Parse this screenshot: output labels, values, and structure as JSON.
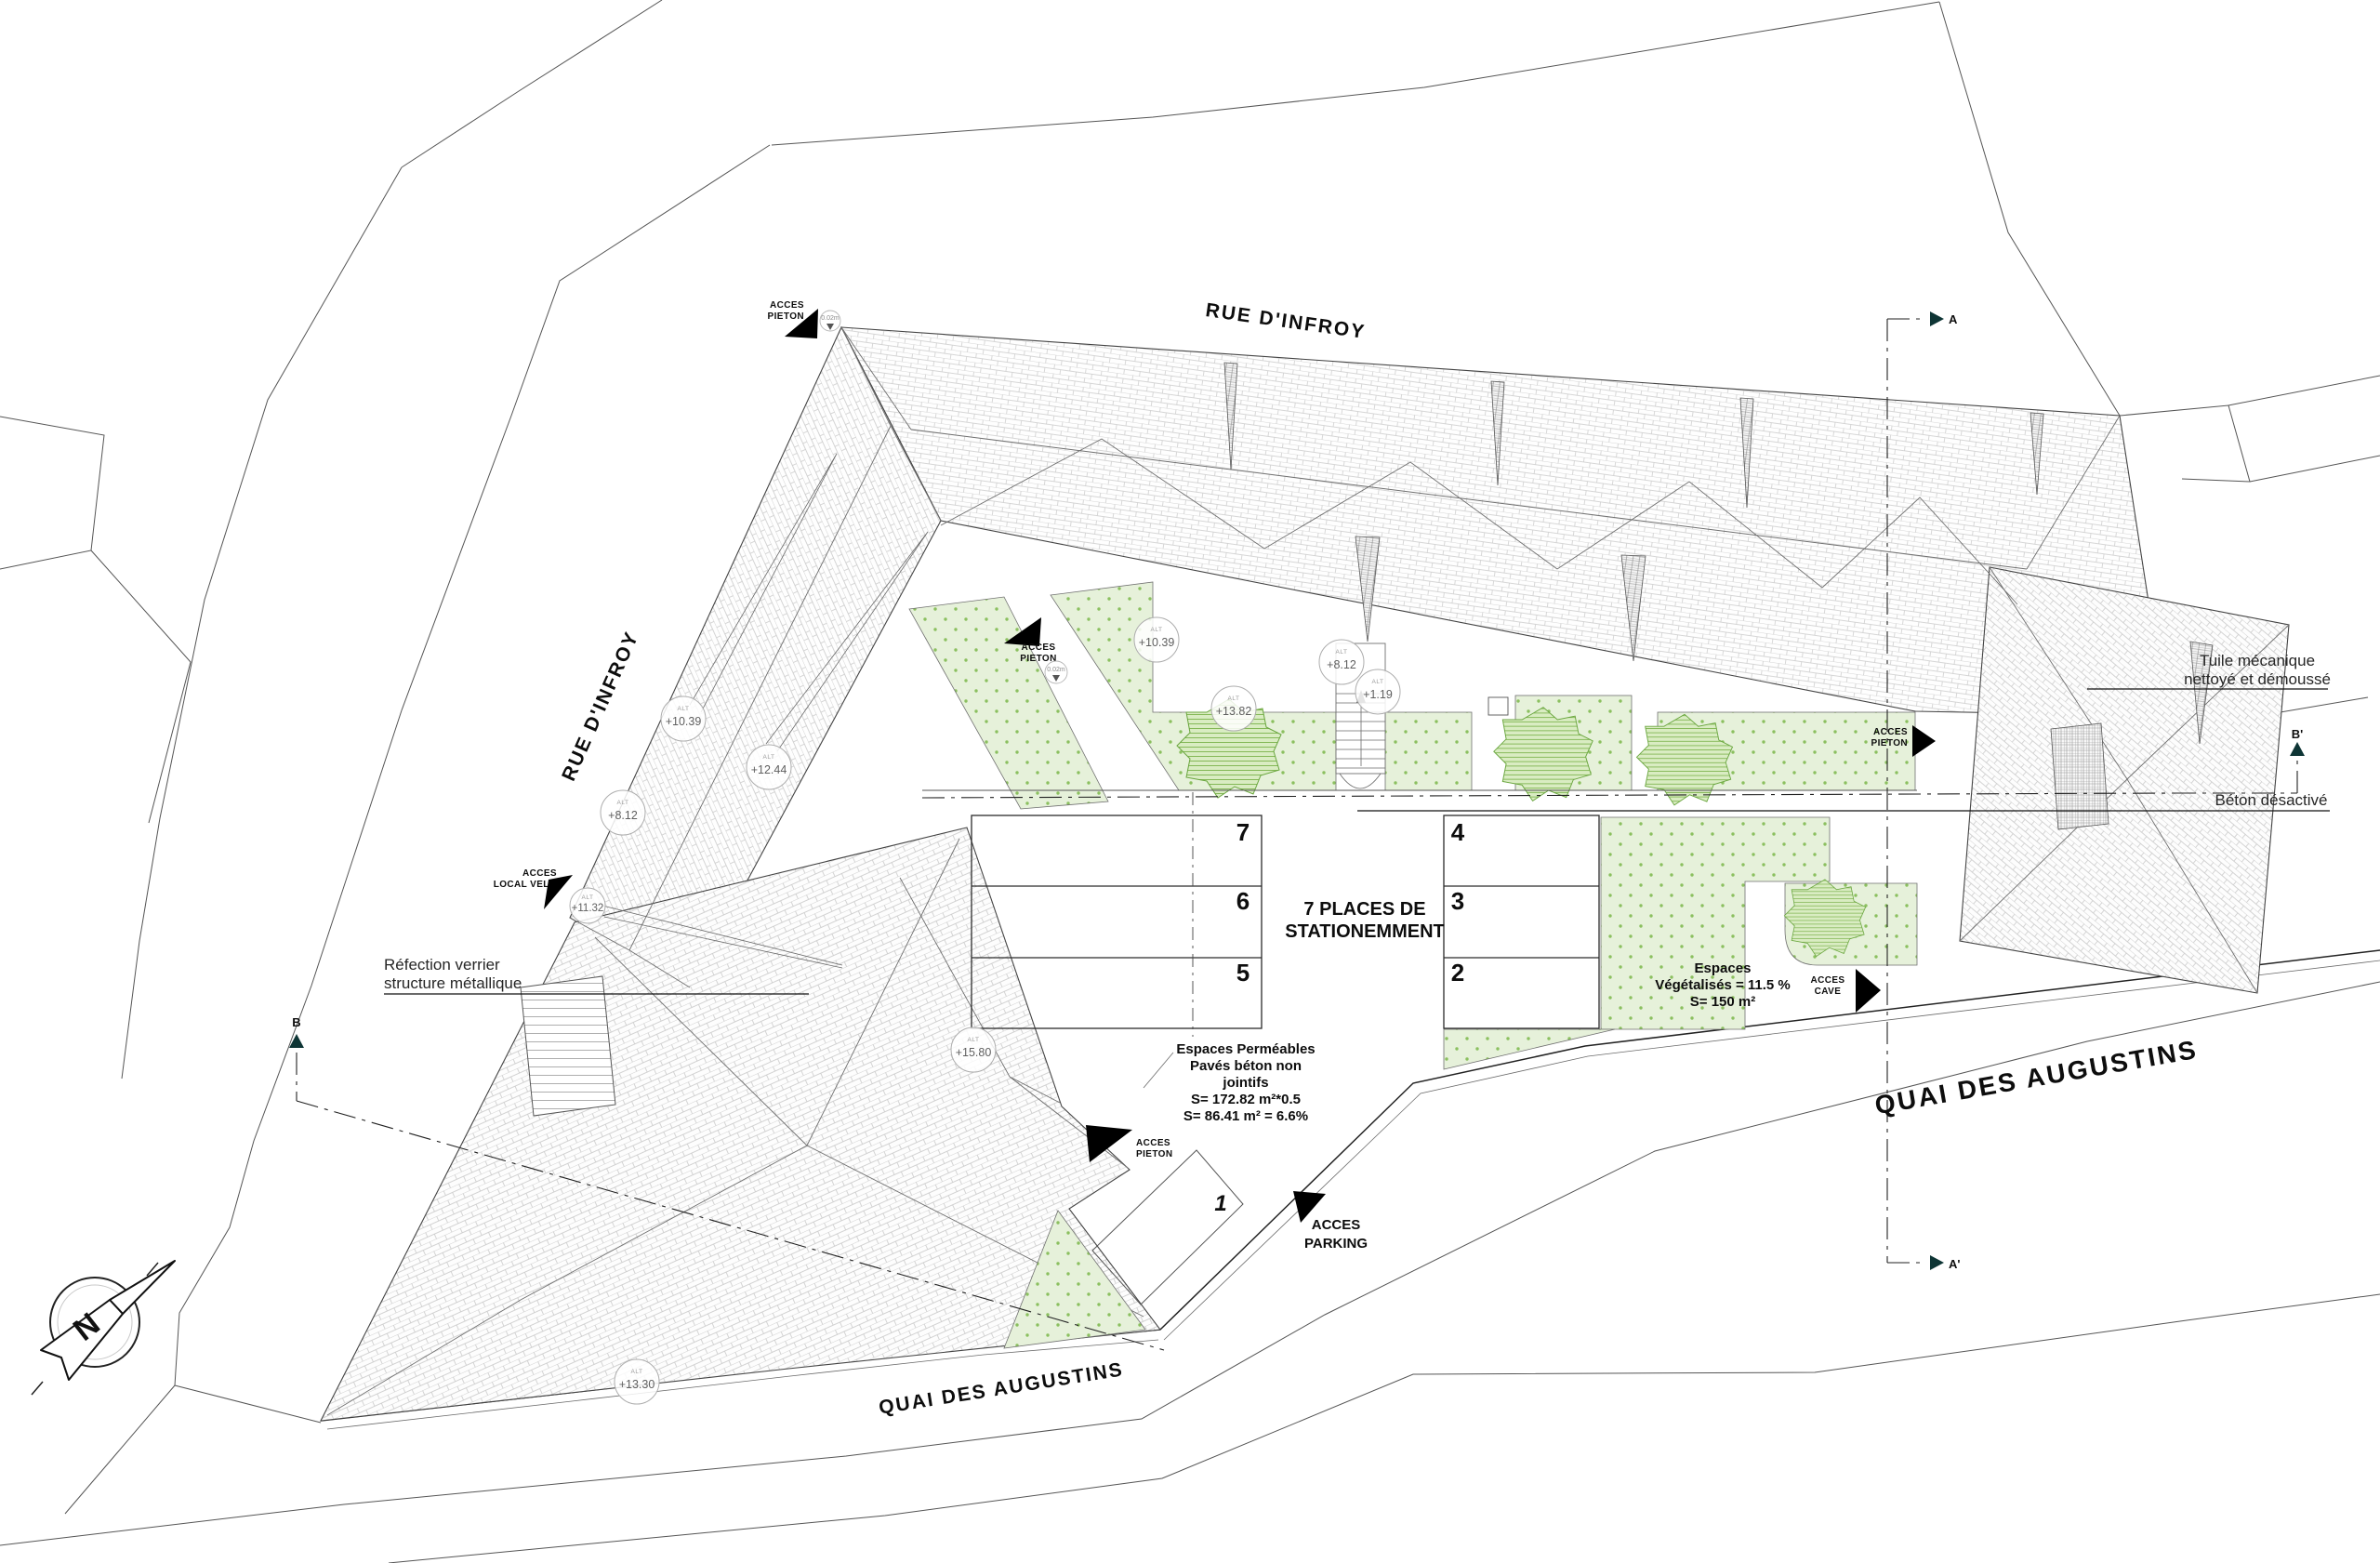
{
  "streets": {
    "top": "RUE D'INFROY",
    "left": "RUE D'INFROY",
    "bottom": "QUAI DES AUGUSTINS",
    "right": "QUAI DES AUGUSTINS"
  },
  "access": {
    "acces": "ACCES",
    "pieton": "PIETON",
    "local_velo": "LOCAL VELO",
    "cave": "CAVE",
    "parking": "PARKING"
  },
  "parking_area": {
    "title_line1": "7 PLACES DE",
    "title_line2": "STATIONEMMENT",
    "stalls": [
      "1",
      "2",
      "3",
      "4",
      "5",
      "6",
      "7"
    ]
  },
  "notes": {
    "permeable": [
      "Espaces Perméables",
      "Pavés béton non",
      "jointifs",
      "S= 172.82 m²*0.5",
      "S= 86.41 m² = 6.6%"
    ],
    "vegetal": [
      "Espaces",
      "Végétalisés = 11.5 %",
      "S= 150 m²"
    ],
    "tuile": [
      "Tuile mécanique",
      "nettoyé et démoussé"
    ],
    "beton": "Béton désactivé",
    "verrier": [
      "Réfection verrier",
      "structure métallique"
    ]
  },
  "levels": [
    {
      "label": "+10.39"
    },
    {
      "label": "+12.44"
    },
    {
      "label": "+8.12"
    },
    {
      "label": "+10.39"
    },
    {
      "label": "+13.82"
    },
    {
      "label": "+8.12"
    },
    {
      "label": "+1.19"
    },
    {
      "label": "+11.32"
    },
    {
      "label": "+15.80"
    },
    {
      "label": "+13.30"
    }
  ],
  "misc": {
    "alt": "ALT",
    "threshold": "0.02m"
  },
  "sections": {
    "a": "A",
    "a_prime": "A'",
    "b": "B",
    "b_prime": "B'"
  },
  "compass": {
    "north": "N"
  },
  "colors": {
    "green_fill": "#e6f1da",
    "green_dot": "#8bc05f",
    "roof_line": "#c9c9c9",
    "section_arrow": "#0e3535"
  }
}
